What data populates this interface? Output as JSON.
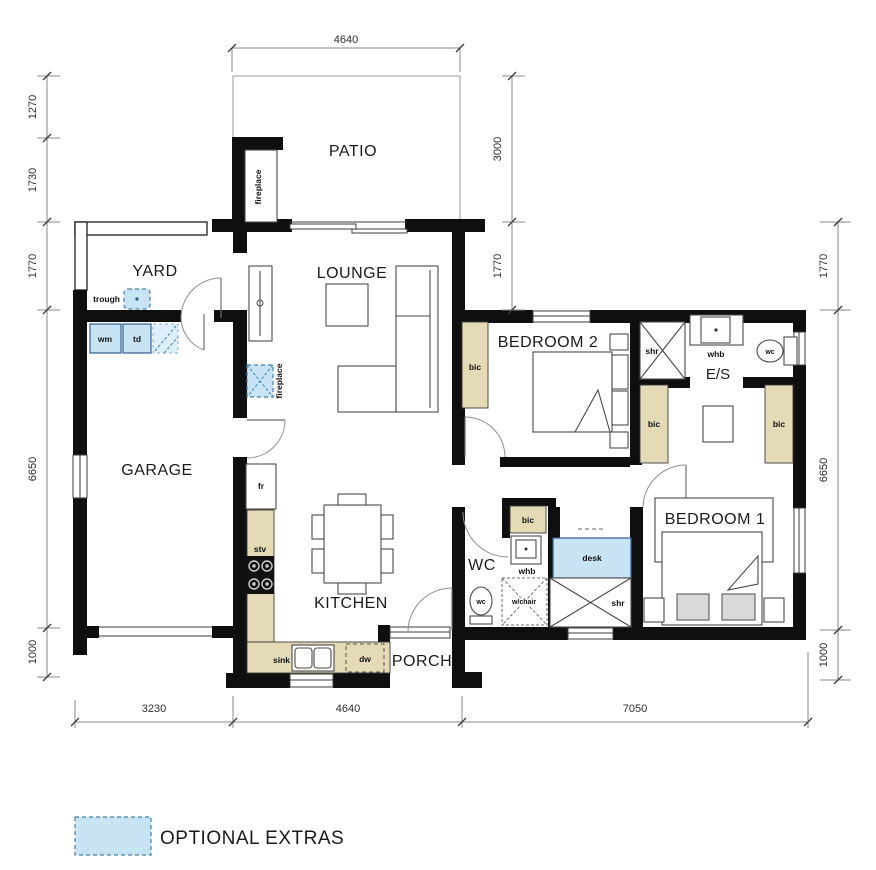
{
  "rooms": {
    "patio": "PATIO",
    "yard": "YARD",
    "lounge": "LOUNGE",
    "garage": "GARAGE",
    "kitchen": "KITCHEN",
    "porch": "PORCH",
    "wc_room": "WC",
    "ensuite": "E/S",
    "bedroom1": "BEDROOM 1",
    "bedroom2": "BEDROOM 2"
  },
  "fixtures": {
    "fireplace_patio": "fireplace",
    "fireplace_lounge": "fireplace",
    "trough": "trough",
    "wm": "wm",
    "td": "td",
    "fr": "fr",
    "stv": "stv",
    "sink": "sink",
    "dw": "dw",
    "bic_bedroom2": "bic",
    "bic_wc_nook": "bic",
    "bic_es_left": "bic",
    "bic_es_right": "bic",
    "shr_es": "shr",
    "shr_hall": "shr",
    "whb_es": "whb",
    "whb_wc": "whb",
    "wc_es": "wc",
    "wc_wc": "wc",
    "desk": "desk",
    "wheelchair": "w/chair"
  },
  "dimensions": {
    "top": "4640",
    "left": [
      "1270",
      "1730",
      "1770",
      "6650",
      "1000"
    ],
    "inner_right": [
      "3000",
      "1770"
    ],
    "right": [
      "1770",
      "6650",
      "1000"
    ],
    "bottom": [
      "3230",
      "4640",
      "7050"
    ]
  },
  "legend": {
    "label": "OPTIONAL EXTRAS"
  },
  "colors": {
    "wall": "#0f0f0f",
    "optional_fill": "#c8e4f4",
    "optional_border": "#3f7fb5",
    "cupboard_fill": "#e4dab6",
    "dimension_line": "#8a8a8a"
  }
}
